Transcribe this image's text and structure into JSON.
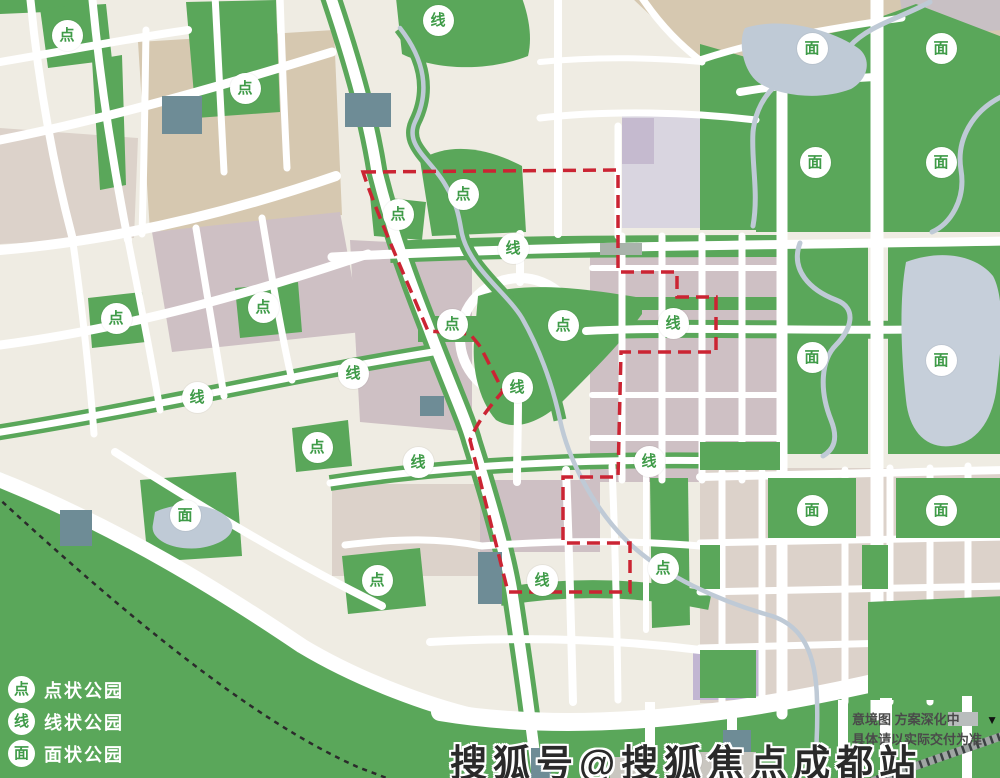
{
  "map": {
    "badge_glyphs": {
      "dot": "点",
      "line": "线",
      "area": "面"
    },
    "badges": [
      {
        "type": "dot",
        "x": 67,
        "y": 35
      },
      {
        "type": "dot",
        "x": 245,
        "y": 88
      },
      {
        "type": "dot",
        "x": 463,
        "y": 194
      },
      {
        "type": "dot",
        "x": 398,
        "y": 214
      },
      {
        "type": "dot",
        "x": 116,
        "y": 318
      },
      {
        "type": "dot",
        "x": 263,
        "y": 307
      },
      {
        "type": "dot",
        "x": 452,
        "y": 324
      },
      {
        "type": "dot",
        "x": 563,
        "y": 325
      },
      {
        "type": "dot",
        "x": 317,
        "y": 447
      },
      {
        "type": "dot",
        "x": 377,
        "y": 580
      },
      {
        "type": "dot",
        "x": 663,
        "y": 568
      },
      {
        "type": "line",
        "x": 438,
        "y": 20
      },
      {
        "type": "line",
        "x": 513,
        "y": 248
      },
      {
        "type": "line",
        "x": 673,
        "y": 323
      },
      {
        "type": "line",
        "x": 353,
        "y": 373
      },
      {
        "type": "line",
        "x": 197,
        "y": 397
      },
      {
        "type": "line",
        "x": 517,
        "y": 387
      },
      {
        "type": "line",
        "x": 418,
        "y": 462
      },
      {
        "type": "line",
        "x": 649,
        "y": 461
      },
      {
        "type": "line",
        "x": 542,
        "y": 580
      },
      {
        "type": "area",
        "x": 812,
        "y": 48
      },
      {
        "type": "area",
        "x": 941,
        "y": 48
      },
      {
        "type": "area",
        "x": 815,
        "y": 162
      },
      {
        "type": "area",
        "x": 941,
        "y": 162
      },
      {
        "type": "area",
        "x": 812,
        "y": 357
      },
      {
        "type": "area",
        "x": 941,
        "y": 360
      },
      {
        "type": "area",
        "x": 185,
        "y": 515
      },
      {
        "type": "area",
        "x": 812,
        "y": 510
      },
      {
        "type": "area",
        "x": 941,
        "y": 510
      },
      {
        "type": "area",
        "x": 686,
        "y": 760
      }
    ]
  },
  "legend": {
    "items": [
      {
        "symbol": "点",
        "label": "点状公园"
      },
      {
        "symbol": "线",
        "label": "线状公园"
      },
      {
        "symbol": "面",
        "label": "面状公园"
      }
    ]
  },
  "disclaimer": {
    "line1": "意境图  方案深化中",
    "arrow": "▼",
    "line2": "具体请以实际交付为准"
  },
  "watermark": "搜狐号@搜狐焦点成都站",
  "colors": {
    "park_green": "#5aa75a",
    "badge_text_green": "#3f9b48",
    "boundary_red": "#cb2433",
    "water_blue": "#bfcad6",
    "lake_blue": "#c6cfda",
    "base_cream": "#efece3",
    "block_tan": "#d6c8b0",
    "block_mauve": "#cec0c4",
    "block_pink": "#dcd2ca",
    "block_lavender": "#d9d5e0",
    "block_purple": "#c5bacf",
    "block_purple2": "#c2b6d2",
    "block_slate": "#6e8c96",
    "road_white": "#ffffff",
    "railway_black": "#2b2b2b",
    "watermark_dark": "#2a2a2a",
    "disclaimer_gray": "#4a4a4a"
  }
}
